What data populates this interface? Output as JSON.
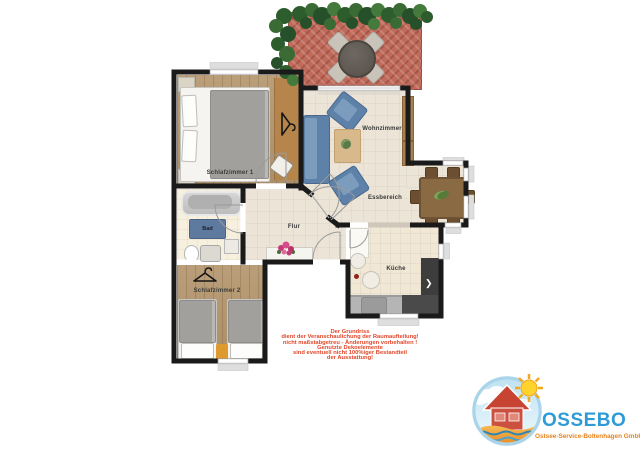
{
  "rooms": {
    "schlafzimmer1": {
      "label": "Schlafzimmer 1"
    },
    "schlafzimmer2": {
      "label": "Schlafzimmer 2"
    },
    "bad": {
      "label": "Bad"
    },
    "flur": {
      "label": "Flur"
    },
    "wohnzimmer": {
      "label": "Wohnzimmer"
    },
    "essbereich": {
      "label": "Essbereich"
    },
    "kueche": {
      "label": "Küche"
    }
  },
  "disclaimer": {
    "lines": [
      "Der Grundriss",
      "dient der Veranschaulichung der Raumaufteilung!",
      "nicht maßstabgetreu - Änderungen vorbehalten !",
      "Genutzte Dekoelemente",
      "sind eventuell nicht 100%iger Bestandteil",
      "der Ausstattung!"
    ]
  },
  "logo": {
    "name": "OSSEBO",
    "subtitle": "Ostsee-Service-Boltenhagen GmbH"
  },
  "palette": {
    "wall": "#1a1a1a",
    "terrace_brick": "#c06a5a",
    "sofa_blue": "#5d81a8",
    "disclaimer_red": "#e2472a",
    "logo_blue": "#2e9bd5",
    "logo_orange": "#e8821e"
  }
}
